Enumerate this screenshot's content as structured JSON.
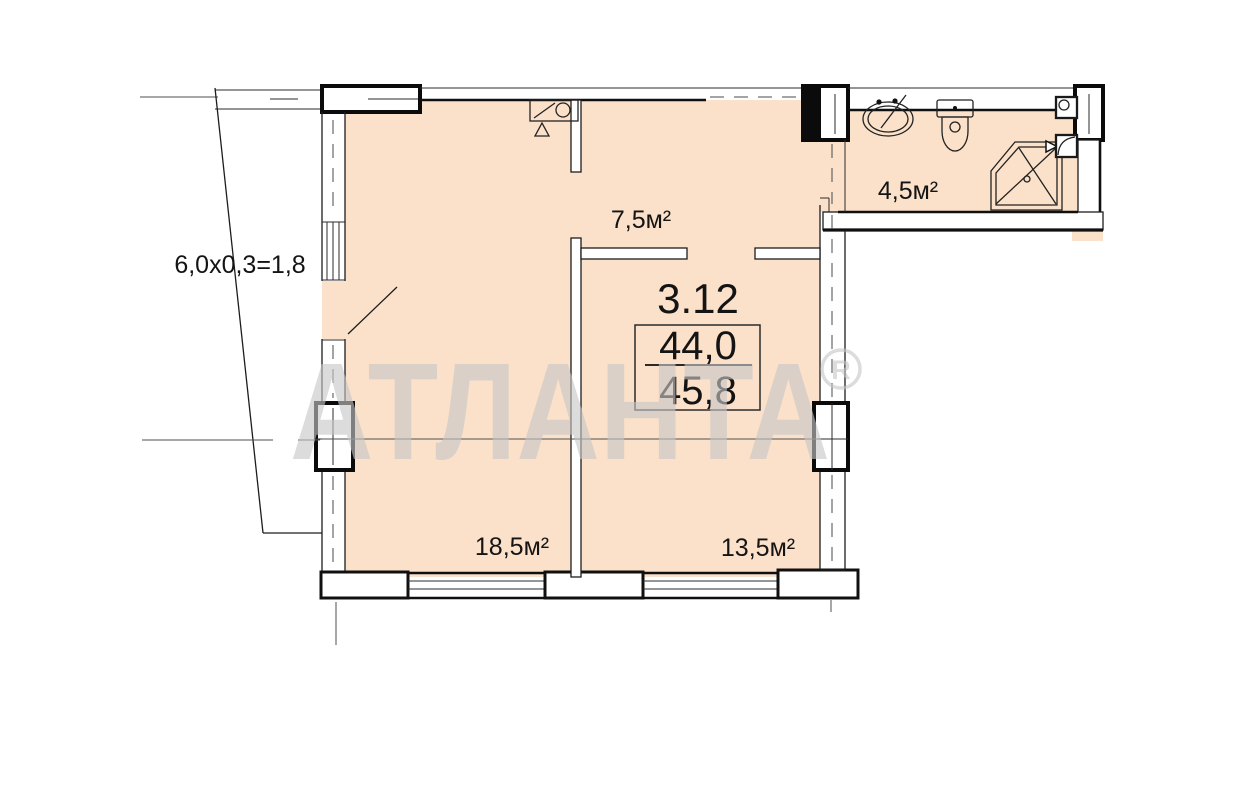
{
  "plan": {
    "unit": {
      "number": "3.12",
      "area_main": "44,0",
      "area_total": "45,8"
    },
    "rooms": {
      "hallway": "7,5м²",
      "bathroom": "4,5м²",
      "living": "18,5м²",
      "bedroom": "13,5м²"
    },
    "balcony": {
      "dimension": "6,0x0,3=1,8"
    },
    "watermark": {
      "text": "АТЛАНТА",
      "registered_symbol": "R"
    },
    "icons": [
      "sink-icon",
      "toilet-icon",
      "shower-icon",
      "kitchen-sink-icon"
    ],
    "colors": {
      "floor_fill": "#fbe1c9",
      "wall_line": "#101010",
      "watermark": "#c7c7c7",
      "background": "#ffffff"
    }
  }
}
